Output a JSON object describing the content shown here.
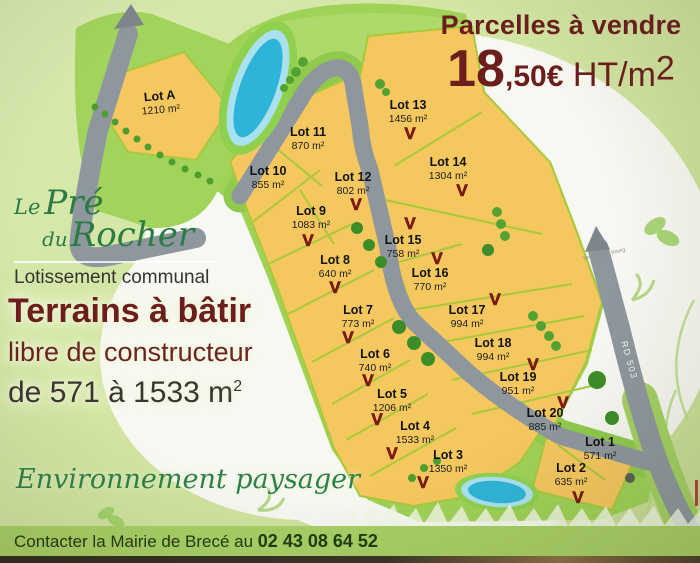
{
  "sign": {
    "price_header": "Parcelles à vendre",
    "price_int": "18",
    "price_cents": ",50€",
    "price_unit": " HT/m",
    "price_sup": "2",
    "logo": {
      "le": "Le",
      "pre": "Pré",
      "du": "du",
      "rocher": "Rocher",
      "subtitle": "Lotissement communal"
    },
    "headline": "Terrains à bâtir",
    "subline1": "libre de constructeur",
    "size_range": "de 571 à 1533 m",
    "size_range_sup": "2",
    "environment": "Environnement paysager",
    "contact_prefix": "Contacter la Mairie de Brecé au ",
    "contact_phone": "02 43 08 64 52"
  },
  "map": {
    "road_label": "RD 503",
    "arrow_label": "Vers centre bourg",
    "sold_marker": "V",
    "lots": [
      {
        "id": "A",
        "name": "Lot A",
        "area": "1210 m²",
        "sold": false
      },
      {
        "id": "1",
        "name": "Lot 1",
        "area": "571 m²",
        "sold": false
      },
      {
        "id": "2",
        "name": "Lot 2",
        "area": "635 m²",
        "sold": true
      },
      {
        "id": "3",
        "name": "Lot 3",
        "area": "1350 m²",
        "sold": true
      },
      {
        "id": "4",
        "name": "Lot 4",
        "area": "1533 m²",
        "sold": true
      },
      {
        "id": "5",
        "name": "Lot 5",
        "area": "1206 m²",
        "sold": true
      },
      {
        "id": "6",
        "name": "Lot 6",
        "area": "740 m²",
        "sold": true
      },
      {
        "id": "7",
        "name": "Lot 7",
        "area": "773 m²",
        "sold": true
      },
      {
        "id": "8",
        "name": "Lot 8",
        "area": "640 m²",
        "sold": true
      },
      {
        "id": "9",
        "name": "Lot 9",
        "area": "1083 m²",
        "sold": true
      },
      {
        "id": "10",
        "name": "Lot 10",
        "area": "855 m²",
        "sold": false
      },
      {
        "id": "11",
        "name": "Lot 11",
        "area": "870 m²",
        "sold": false
      },
      {
        "id": "12",
        "name": "Lot 12",
        "area": "802 m²",
        "sold": true
      },
      {
        "id": "13",
        "name": "Lot 13",
        "area": "1456 m²",
        "sold": true
      },
      {
        "id": "14",
        "name": "Lot 14",
        "area": "1304 m²",
        "sold": true
      },
      {
        "id": "15",
        "name": "Lot 15",
        "area": "758 m²",
        "sold": true
      },
      {
        "id": "16",
        "name": "Lot 16",
        "area": "770 m²",
        "sold": true
      },
      {
        "id": "17",
        "name": "Lot 17",
        "area": "994 m²",
        "sold": true
      },
      {
        "id": "18",
        "name": "Lot 18",
        "area": "994 m²",
        "sold": false
      },
      {
        "id": "19",
        "name": "Lot 19",
        "area": "951 m²",
        "sold": true
      },
      {
        "id": "20",
        "name": "Lot 20",
        "area": "885 m²",
        "sold": true
      }
    ]
  },
  "colors": {
    "maroon": "#6b1e1c",
    "logo_green": "#2c7b44",
    "parcel_yellow": "#f5c75f",
    "road_gray": "#8e979e",
    "sold_red": "#8e1a17",
    "pond_blue": "#2fb4d9",
    "background_green": "#d2e5a2",
    "strip_green": "#a9cf66"
  }
}
